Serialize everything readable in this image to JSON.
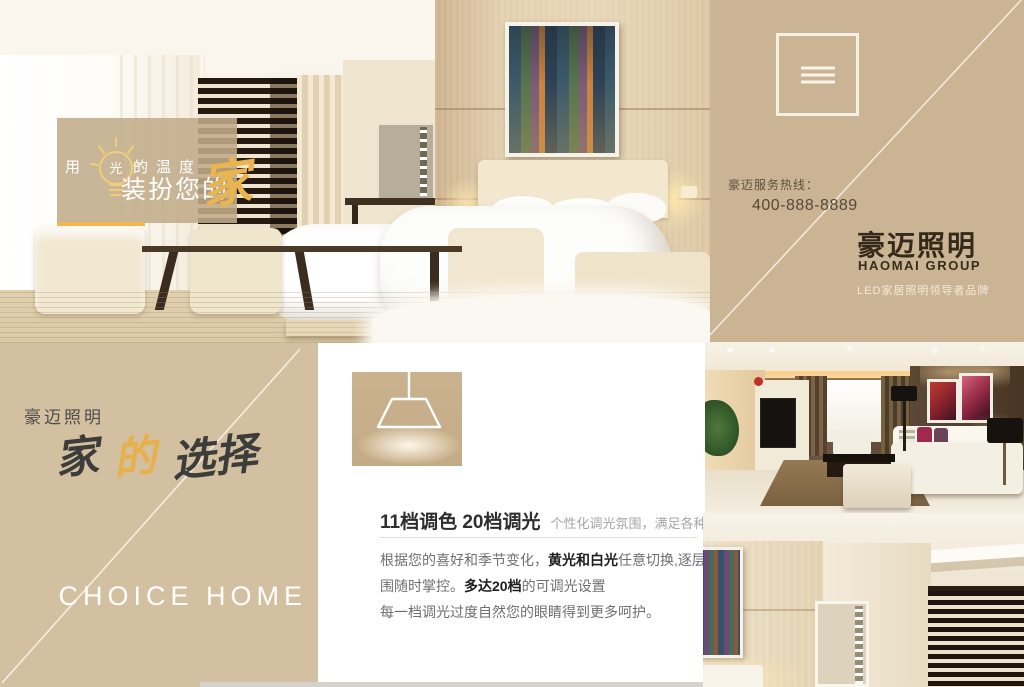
{
  "hero": {
    "overlay": {
      "prefix": "用",
      "bulb_char": "光",
      "suffix": "的温度",
      "line2": "装扮您的",
      "home_char": "家"
    }
  },
  "brand_panel": {
    "menu_icon": "hamburger-icon",
    "hotline_label": "豪迈服务热线：",
    "hotline_number": "400-888-8889",
    "brand_cn": "豪迈照明",
    "brand_en": "HAOMAI GROUP",
    "tagline": "LED家居照明领导者品牌"
  },
  "choice_panel": {
    "brand": "豪迈照明",
    "calligraphy": [
      "家",
      "的",
      "选择"
    ],
    "english": "CHOICE HOME"
  },
  "feature_panel": {
    "heading_strong": "11档调色 20档调光",
    "heading_sub": "个性化调光氛围，满足各种喜好",
    "body_lines": [
      [
        {
          "t": "根据您的喜好和季节变化，",
          "b": false
        },
        {
          "t": "黄光和白光",
          "b": true
        },
        {
          "t": "任意切换,逐层渐变，氛",
          "b": false
        }
      ],
      [
        {
          "t": "围随时掌控。",
          "b": false
        },
        {
          "t": "多达20档",
          "b": true
        },
        {
          "t": "的可调光设置",
          "b": false
        }
      ],
      [
        {
          "t": "每一档调光过度自然您的眼睛得到更多呵护。",
          "b": false
        }
      ]
    ]
  },
  "colors": {
    "panel_tan": "#cbb494",
    "panel_tan_light": "#d3c0a0",
    "accent_gold": "#eab54e",
    "brand_text": "#352a1a",
    "heading_text": "#2e2e2e"
  }
}
